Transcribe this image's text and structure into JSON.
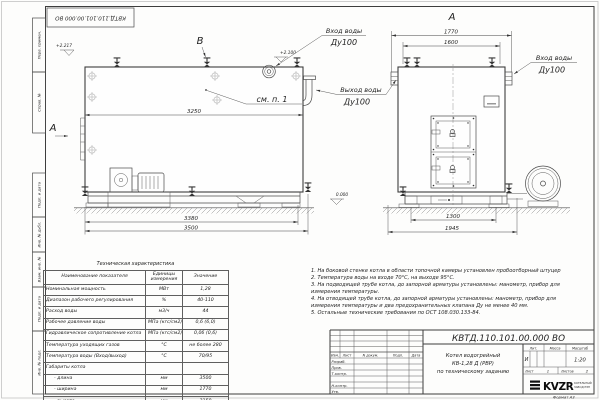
{
  "frame": {
    "side_labels": [
      "Перв. примен.",
      "Справ. №",
      "Подп. и дата",
      "Инв. № дубл.",
      "Взам. инв. №",
      "Подп. и дата",
      "Инв. № подл."
    ],
    "stamp": "КВТД.110.101.00.000 ВО",
    "format_note": "Формат  А3"
  },
  "drawing": {
    "views": {
      "b": "В",
      "a_side": "А",
      "a_front": "А"
    },
    "callout": "см. п. 1",
    "elevations": {
      "top_left": "+2.217",
      "top_mid": "+2.100",
      "ground": "0.000"
    },
    "ports": {
      "inlet_top": [
        "Вход воды",
        "Ду100"
      ],
      "outlet": [
        "Выход воды",
        "Ду100"
      ],
      "inlet_front": [
        "Вход воды",
        "Ду100"
      ]
    },
    "dims": {
      "d3250": "3250",
      "d3380": "3380",
      "d3500": "3500",
      "d1770": "1770",
      "d1600": "1600",
      "d1300": "1300",
      "d1945": "1945"
    }
  },
  "tech_table": {
    "title": "Техническая характеристика",
    "headers": [
      "Наименование показателя",
      "Единицы измерения",
      "Значение"
    ],
    "rows": [
      [
        "Номинальная мощность",
        "МВт",
        "1,28"
      ],
      [
        "Диапазон рабочего регулирования",
        "%",
        "40-110"
      ],
      [
        "Расход воды",
        "м3/ч",
        "44"
      ],
      [
        "Рабочее давление воды",
        "МПа (кгс/см2)",
        "0,6 (6,0)"
      ],
      [
        "Гидравлическое сопротивление котла",
        "МПа (кгс/см2)",
        "0,06 (0,6)"
      ],
      [
        "Температура уходящих газов",
        "°С",
        "не более 280"
      ],
      [
        "Температура воды (Вход/выход)",
        "°С",
        "70/95"
      ],
      [
        "Габариты котла",
        "",
        ""
      ],
      [
        "- длина",
        "мм",
        "3500"
      ],
      [
        "- ширина",
        "мм",
        "1770"
      ],
      [
        "- высота",
        "мм",
        "2150"
      ]
    ]
  },
  "notes": [
    "1.  На боковой стенке котла в области топочной камеры установлен пробоотборный штуцер",
    "2.  Температура воды на входе 70°С, на выходе 95°С.",
    "3.  На подводящей трубе котла, до запорной арматуры установлены: манометр, прибор для измерения температуры.",
    "4.  На отводящей трубе котла, до запорной арматуры установлены: манометр, прибор для измерения температуры и два предохранительных клапана Ду не менее 40 мм.",
    "5.  Остальные технические требования по ОСТ 108.030.133-84."
  ],
  "title_block": {
    "doc_number": "КВТД.110.101.00.000  ВО",
    "product_name": [
      "Котел водогрейный",
      "КВ-1,28 Д (РВР)",
      "по техническому заданию"
    ],
    "cols": {
      "izm": "Изм.",
      "list": "Лист",
      "ndoc": "N докум.",
      "podp": "Подп.",
      "data": "Дата"
    },
    "roles": {
      "razrab": "Разраб.",
      "prov": "Пров.",
      "tkontr": "Т.контр.",
      "nkontr": "Н.контр.",
      "utv": "Утв."
    },
    "lit": {
      "label": "Лит.",
      "value": "И"
    },
    "massa": {
      "label": "Масса"
    },
    "scale": {
      "label": "Масштаб",
      "value": "1:20"
    },
    "sheet": {
      "label": "Лист",
      "value": "1"
    },
    "sheets": {
      "label": "Листов",
      "value": "2"
    },
    "company": {
      "logo": "KVZR",
      "line1": "КОТЕЛЬНЫЙ",
      "line2": "ЗАВОД РЭП"
    }
  }
}
